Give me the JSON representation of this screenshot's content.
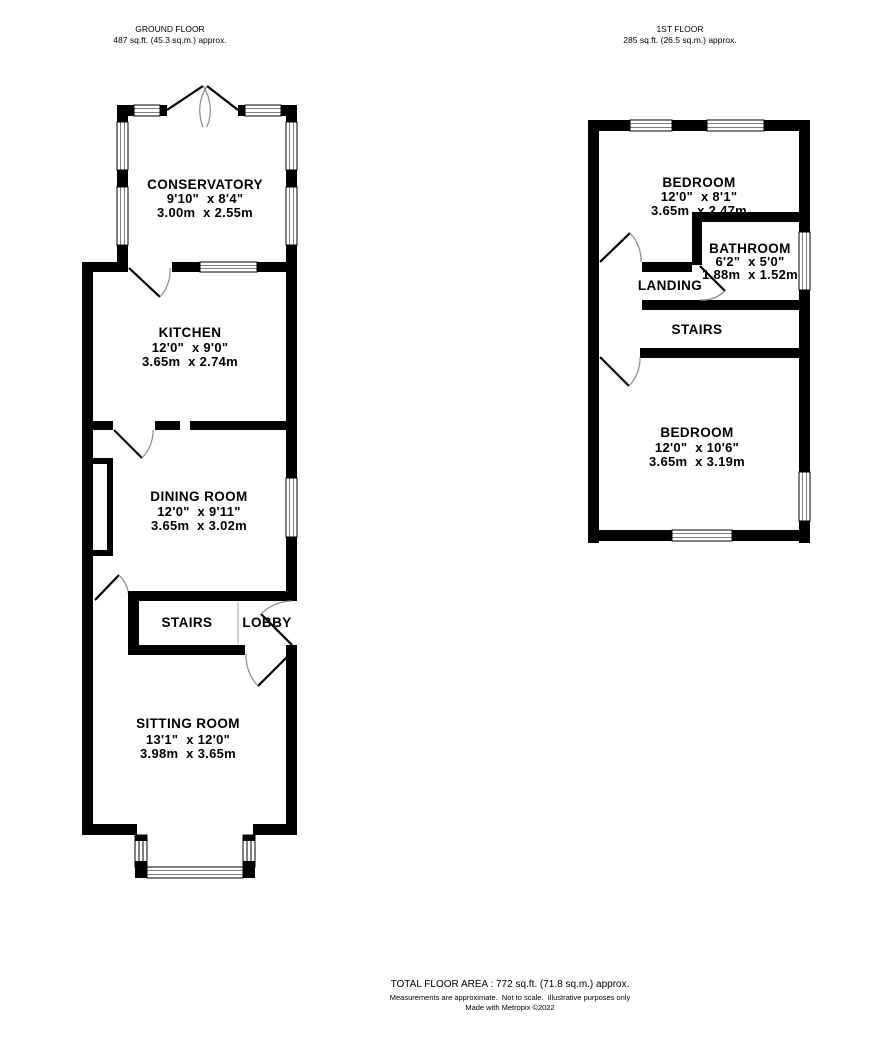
{
  "colors": {
    "wall": "#000000",
    "door_arc": "#8a8a8a",
    "stair_edge": "#c0c0c0",
    "background": "#ffffff"
  },
  "ground_floor": {
    "title": "GROUND FLOOR",
    "area": "487 sq.ft. (45.3 sq.m.) approx.",
    "conservatory": {
      "name": "CONSERVATORY",
      "imperial": "9'10\"  x 8'4\"",
      "metric": "3.00m  x 2.55m"
    },
    "kitchen": {
      "name": "KITCHEN",
      "imperial": "12'0\"  x 9'0\"",
      "metric": "3.65m  x 2.74m"
    },
    "dining_room": {
      "name": "DINING ROOM",
      "imperial": "12'0\"  x 9'11\"",
      "metric": "3.65m  x 3.02m"
    },
    "stairs": {
      "name": "STAIRS"
    },
    "lobby": {
      "name": "LOBBY"
    },
    "sitting_room": {
      "name": "SITTING ROOM",
      "imperial": "13'1\"  x 12'0\"",
      "metric": "3.98m  x 3.65m"
    }
  },
  "first_floor": {
    "title": "1ST FLOOR",
    "area": "285 sq.ft. (26.5 sq.m.) approx.",
    "bedroom_front": {
      "name": "BEDROOM",
      "imperial": "12'0\"  x 8'1\"",
      "metric": "3.65m  x 2.47m"
    },
    "bathroom": {
      "name": "BATHROOM",
      "imperial": "6'2\"  x 5'0\"",
      "metric": "1.88m  x 1.52m"
    },
    "landing": {
      "name": "LANDING"
    },
    "stairs": {
      "name": "STAIRS"
    },
    "bedroom_back": {
      "name": "BEDROOM",
      "imperial": "12'0\"  x 10'6\"",
      "metric": "3.65m  x 3.19m"
    }
  },
  "footer": {
    "total": "TOTAL FLOOR AREA : 772 sq.ft. (71.8 sq.m.) approx.",
    "disclaimer": "Measurements are approximate.  Not to scale.  Illustrative purposes only",
    "credit": "Made with Metropix ©2022"
  }
}
